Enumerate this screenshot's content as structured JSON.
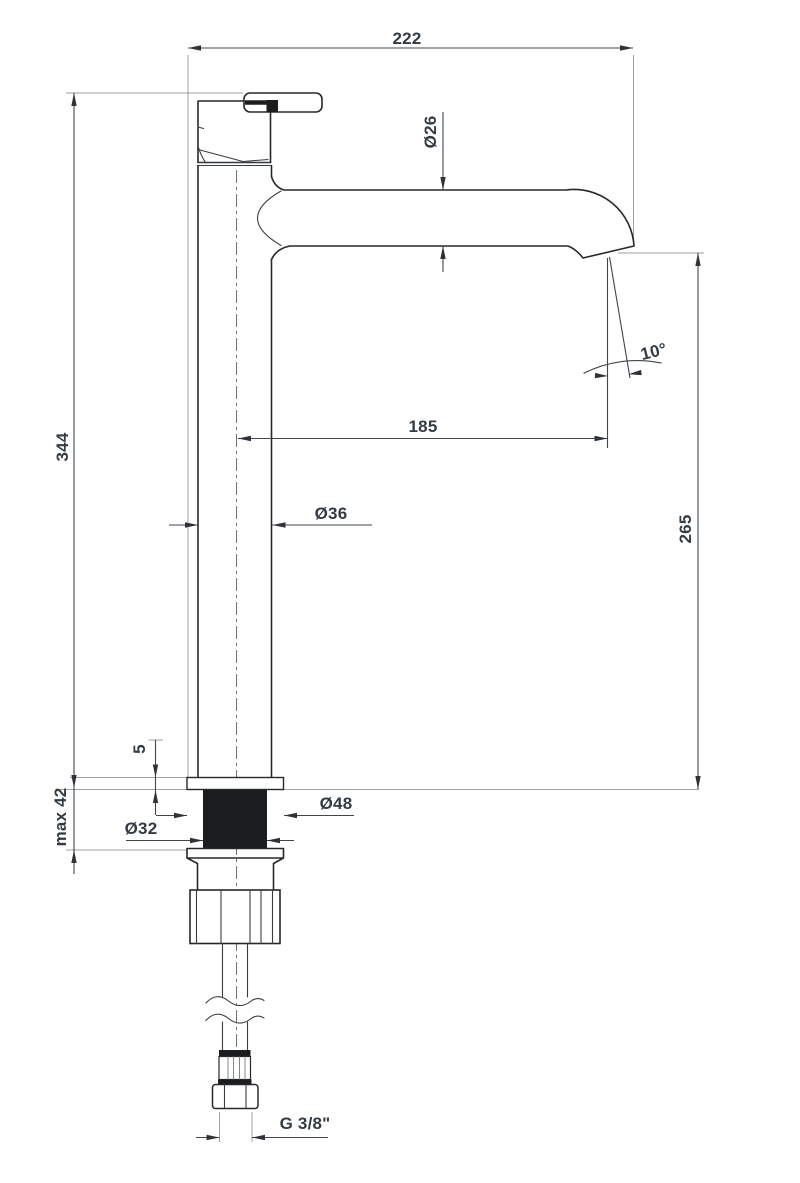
{
  "drawing": {
    "kind": "faucet-dimension-drawing"
  },
  "dimensions": {
    "total_width": "222",
    "spout_tube_diameter": "Ø26",
    "total_height": "344",
    "spout_reach": "185",
    "spout_angle": "10°",
    "outlet_height": "265",
    "body_diameter": "Ø36",
    "base_plate_thickness": "5",
    "max_mounting_thickness": "max 42",
    "shank_diameter": "Ø32",
    "base_plate_diameter": "Ø48",
    "hose_thread": "G 3/8\""
  },
  "colors": {
    "background": "#ffffff",
    "object_line": "#26282b",
    "dimension_line": "#41464d",
    "extension_line": "#9aa0a4",
    "label_text": "#333b43",
    "solid_fill": "#1c1d1f"
  }
}
